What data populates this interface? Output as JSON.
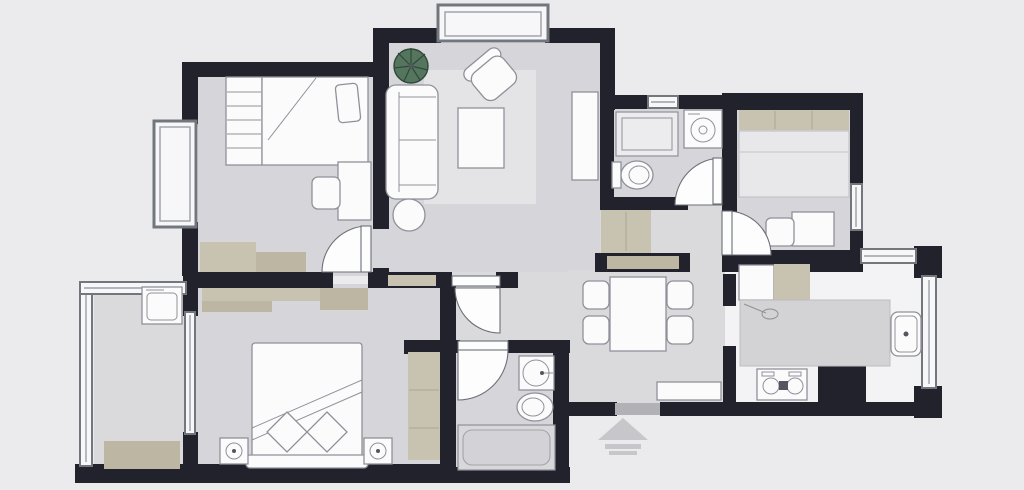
{
  "colors": {
    "background": "#ebebed",
    "wall": "#22222d",
    "floor": "#d6d6da",
    "floor_hall": "#dadadd",
    "floor_kitchen": "#f3f3f5",
    "furniture_white": "#fbfbfc",
    "furniture_stroke": "#90909a",
    "wood": "#c8c2b0",
    "wood_dark": "#bcb6a3",
    "rug": "#e4e4e7",
    "counter": "#d3d3d6",
    "bed_light": "#e8e8eb",
    "door_fill": "#fdfdfe",
    "door_stroke": "#6b7077",
    "window_frame": "#72777d",
    "window_fill": "#f7f7f9",
    "glass_line": "#9aa0a6",
    "plant_green": "#55755e",
    "plant_dark": "#2e4a39",
    "arrow": "#c7c7cb",
    "threshold": "#b2b2b6",
    "shower_fill": "#ececee",
    "tub_fill": "#d8d8db",
    "tub_inner": "#d3d3d7"
  },
  "labels": {
    "plan": "apartment-floor-plan",
    "living_room": "living-room",
    "bedroom_small": "bedroom-top-left",
    "bedroom_second": "bedroom-top-right",
    "bedroom_master": "master-bedroom",
    "bathroom_top": "bathroom-top",
    "bathroom_main": "bathroom-main",
    "kitchen": "kitchen",
    "dining": "dining-area",
    "hallway": "hallway",
    "balcony": "balcony",
    "entry": "entry",
    "sofa": "sofa",
    "armchair": "armchair",
    "coffee_table": "coffee-table",
    "tv_console": "tv-console",
    "plant": "potted-plant",
    "rug": "area-rug",
    "single_bed": "single-bed",
    "double_bed": "double-bed",
    "wardrobe": "wardrobe",
    "desk": "desk",
    "dining_table": "dining-table",
    "shoe_cabinet": "shoe-cabinet",
    "sideboard": "sideboard",
    "fridge": "refrigerator",
    "stove": "cooktop",
    "sink": "sink",
    "shower": "shower",
    "washing_machine": "washing-machine",
    "toilet": "toilet",
    "bathtub": "bathtub",
    "entry_arrow": "entry-direction-arrow"
  }
}
